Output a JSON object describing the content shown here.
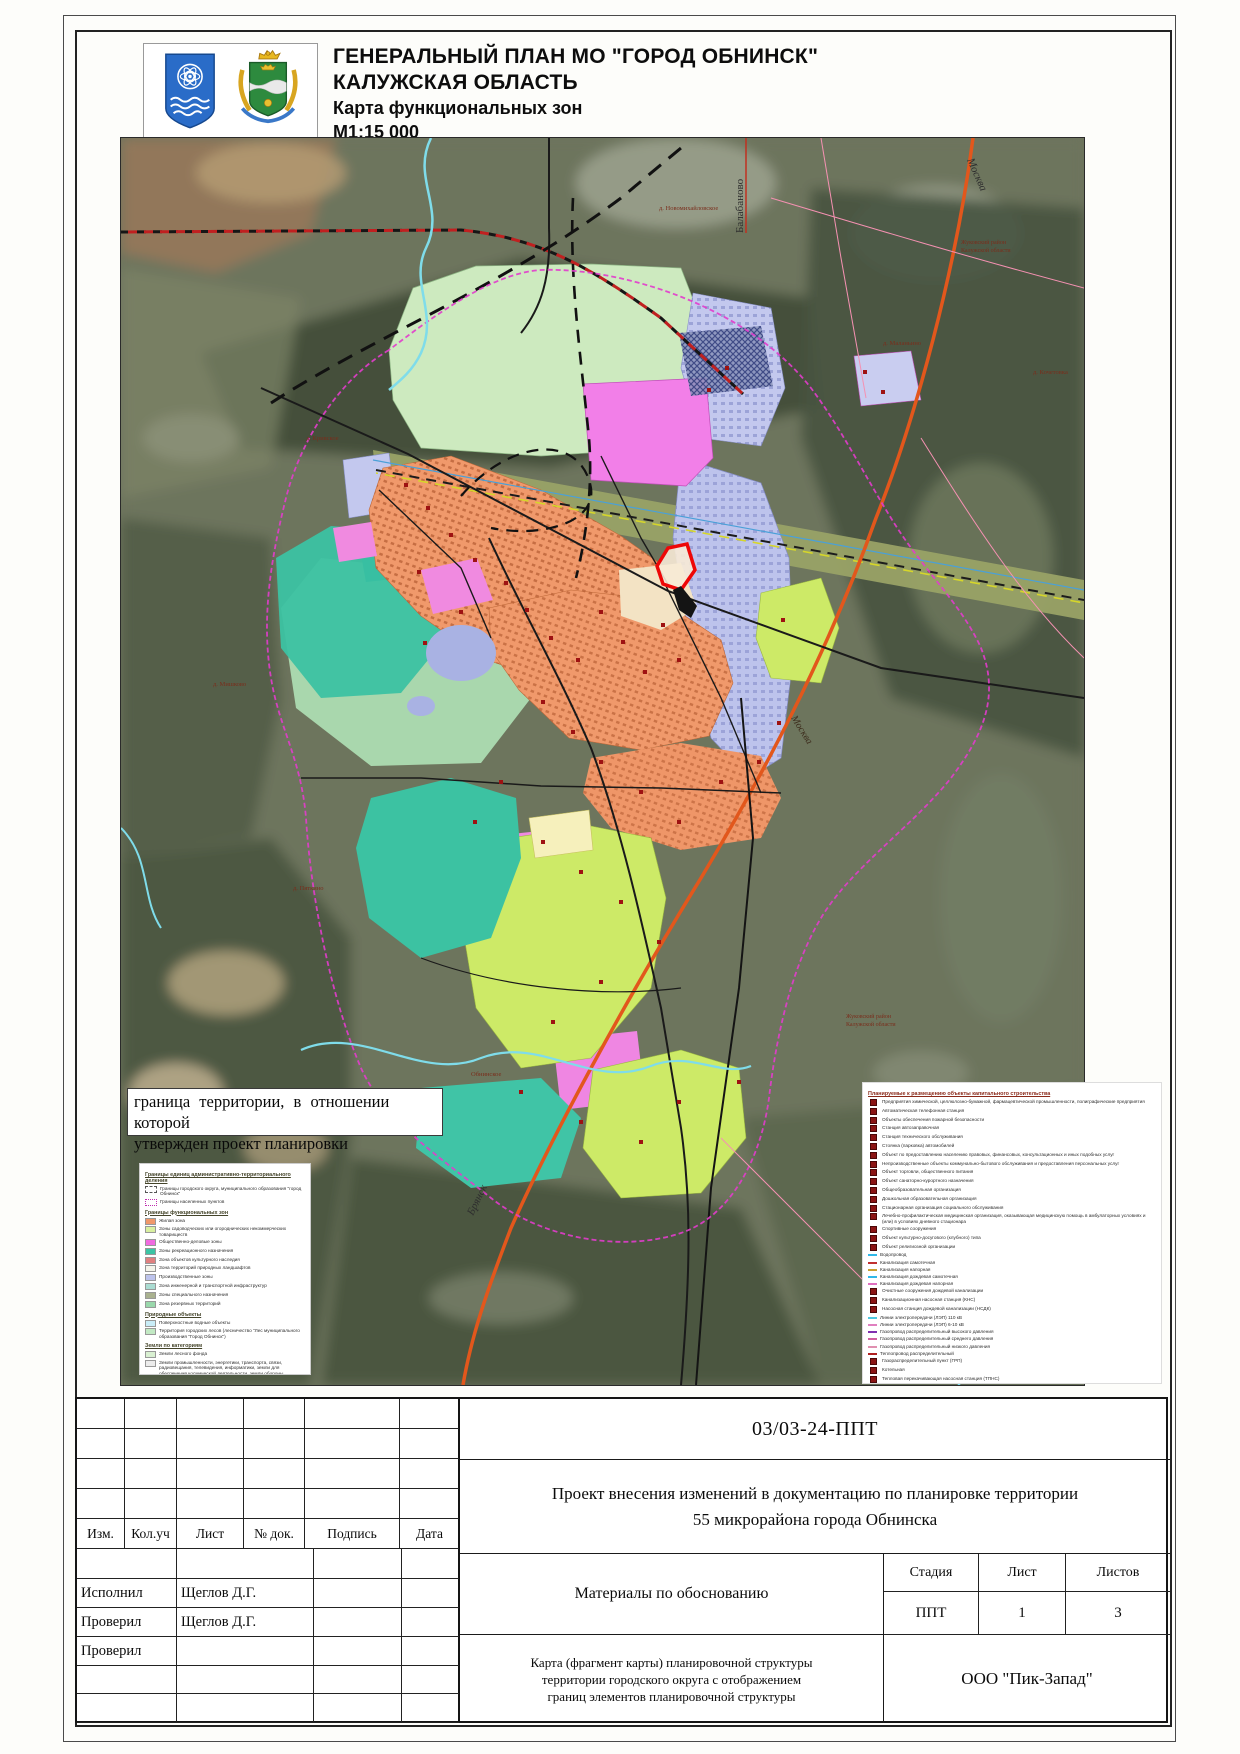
{
  "header": {
    "title_line1": "ГЕНЕРАЛЬНЫЙ ПЛАН МО \"ГОРОД ОБНИНСК\"",
    "title_line2": "КАЛУЖСКАЯ ОБЛАСТЬ",
    "title_line3": "Карта функциональных зон",
    "scale": "М1:15 000",
    "logos": [
      "obninsk-coat-of-arms",
      "kaluga-oblast-coat-of-arms"
    ]
  },
  "map": {
    "note_line1": "граница территории, в отношении которой",
    "note_line2": "утвержден проект планировки",
    "labels": {
      "balabanovo": "Балабаново",
      "moscow_top": "Москва",
      "moscow_right": "Москва",
      "bryansk": "Брянск",
      "novomikhaylovskoe": "д. Новомихайловское",
      "malanino": "д. Маланьино",
      "krivskoe": "д. Кривское",
      "obninskoe": "Обнинское",
      "zhukovsky_1": "Жуковский район",
      "zhukovsky_2": "Калужской области",
      "mishkovo": "д. Мишково",
      "pyatkino": "д. Пяткино",
      "kochetovka": "д. Кочетовка"
    },
    "colors": {
      "residential": "#f0996b",
      "public_business": "#f27fe8",
      "industrial": "#bdc3ec",
      "recreation": "#3cc2a2",
      "gardening": "#cdea67",
      "pale_green_zone": "#cdeabf",
      "city_forest": "#a9d7ad",
      "railway_band": "#99a266",
      "highway_orange": "#e2571c",
      "water": "#7fdcea",
      "project_boundary_red": "#ee0707",
      "city_boundary_magenta": "#e23ccc"
    }
  },
  "legend_left": {
    "sections": [
      {
        "heading": "Границы единиц административно-территориального деления",
        "items": [
          {
            "sym": "admin1",
            "label": "Границы городского округа, муниципального образования \"город Обнинск\""
          },
          {
            "sym": "admin2",
            "label": "Границы населенных пунктов"
          }
        ]
      },
      {
        "heading": "Границы функциональных зон",
        "items": [
          {
            "sym": "swatch",
            "color": "#f0986a",
            "label": "Жилая зона"
          },
          {
            "sym": "swatch",
            "color": "#d9f0a0",
            "label": "Зоны садоводческих или огороднических некоммерческих товариществ"
          },
          {
            "sym": "swatch",
            "color": "#f06ae0",
            "label": "Общественно-деловые зоны"
          },
          {
            "sym": "swatch",
            "color": "#3cc4a4",
            "label": "Зоны рекреационного назначения"
          },
          {
            "sym": "swatch",
            "color": "#e08080",
            "label": "Зона объектов культурного наследия"
          },
          {
            "sym": "swatch",
            "color": "#f4f4ea",
            "label": "Зона территорий природных ландшафтов"
          },
          {
            "sym": "swatch",
            "color": "#bdc3ec",
            "label": "Производственные зоны"
          },
          {
            "sym": "swatch",
            "color": "#aadcd2",
            "label": "Зона инженерной и транспортной инфраструктур"
          },
          {
            "sym": "swatch",
            "color": "#a9b18f",
            "label": "Зоны специального назначения"
          },
          {
            "sym": "swatch",
            "color": "#9ad8ac",
            "label": "Зона резервных территорий"
          }
        ]
      },
      {
        "heading": "Природные объекты",
        "items": [
          {
            "sym": "swatch",
            "color": "#c9edf8",
            "label": "Поверхностные водные объекты"
          },
          {
            "sym": "swatch",
            "color": "#c2e9c4",
            "label": "Территория городских лесов (лесничество \"Лес муниципального образования \"Город Обнинск\")"
          }
        ]
      },
      {
        "heading": "Земли по категориям",
        "items": [
          {
            "sym": "swatch",
            "color": "#d9f0d2",
            "label": "Земли лесного фонда"
          },
          {
            "sym": "swatch",
            "color": "#ececec",
            "label": "Земли промышленности, энергетики, транспорта, связи, радиовещания, телевидения, информатики, земли для обеспечения космической деятельности, земли обороны, безопасности и земли иного специального назначения"
          },
          {
            "sym": "outline",
            "color": "#fdfbe0",
            "label": "Земли сельскохозяйственного использования"
          }
        ]
      },
      {
        "heading": "Объекты транспортной инфраструктуры",
        "note": "сущ.  план.",
        "items": [
          {
            "sym": "pair",
            "color": "#c01818",
            "label": "Автомобильные дороги федерального значения"
          },
          {
            "sym": "pair",
            "color": "#8b1515",
            "label": "Автомобильные дороги регионального значения"
          },
          {
            "sym": "line",
            "color": "#8b1515",
            "label": "Автомобильные дороги местного значения"
          },
          {
            "sym": "pair",
            "color": "#222222",
            "label": "Магистральные улицы общегородского значения"
          },
          {
            "sym": "dline",
            "color": "#222222",
            "label": "Магистральные улицы районного значения"
          },
          {
            "sym": "dline",
            "color": "#555555",
            "label": "Улицы и дороги местного значения"
          },
          {
            "sym": "sq",
            "color": "#111111",
            "label": "Железнодорожный путь общего пользования"
          }
        ]
      }
    ]
  },
  "legend_right": {
    "heading": "Планируемые к размещению объекты капитального строительства",
    "items": [
      {
        "sym": "sq",
        "label": "Предприятия химической, целлюлозно-бумажной, фармацевтической промышленности, полиграфические предприятия"
      },
      {
        "sym": "sq",
        "label": "Автоматическая телефонная станция"
      },
      {
        "sym": "sq",
        "label": "Объекты обеспечения пожарной безопасности"
      },
      {
        "sym": "sq",
        "label": "Станция автозаправочная"
      },
      {
        "sym": "sq",
        "label": "Станция технического обслуживания"
      },
      {
        "sym": "sq",
        "label": "Стоянка (парковка) автомобилей"
      },
      {
        "sym": "sq",
        "label": "Объект по предоставлению населению правовых, финансовых, консультационных и иных подобных услуг"
      },
      {
        "sym": "sq",
        "label": "Непроизводственные объекты коммунально-бытового обслуживания и предоставления персональных услуг"
      },
      {
        "sym": "sq",
        "label": "Объект торговли, общественного питания"
      },
      {
        "sym": "sq",
        "label": "Объект санаторно-курортного назначения"
      },
      {
        "sym": "sq",
        "label": "Общеобразовательная организация"
      },
      {
        "sym": "sq",
        "label": "Дошкольная образовательная организация"
      },
      {
        "sym": "sq",
        "label": "Стационарная организация социального обслуживания"
      },
      {
        "sym": "sq",
        "label": "Лечебно-профилактическая медицинская организация, оказывающая медицинскую помощь в амбулаторных условиях и (или) в условиях дневного стационара"
      },
      {
        "sym": "sq",
        "label": "Спортивные сооружения"
      },
      {
        "sym": "sq",
        "label": "Объект культурно-досугового (клубного) типа"
      },
      {
        "sym": "sq",
        "label": "Объект религиозной организации"
      },
      {
        "sym": "line",
        "color": "#30b8e8",
        "label": "Водопровод"
      },
      {
        "sym": "line",
        "color": "#c03030",
        "label": "Канализация самотечная"
      },
      {
        "sym": "line",
        "color": "#c8a030",
        "label": "Канализация напорная"
      },
      {
        "sym": "dline",
        "color": "#30b8e8",
        "label": "Канализация дождевая самотечная"
      },
      {
        "sym": "line",
        "color": "#e070c0",
        "label": "Канализация дождевая напорная"
      },
      {
        "sym": "sq",
        "label": "Очистные сооружения дождевой канализации"
      },
      {
        "sym": "sq",
        "label": "Канализационная насосная станция (КНС)"
      },
      {
        "sym": "sq",
        "label": "Насосная станция дождевой канализации (НСДК)"
      },
      {
        "sym": "line",
        "color": "#50c8e0",
        "label": "Линии электропередачи (ЛЭП) 110 кВ"
      },
      {
        "sym": "line",
        "color": "#e080c0",
        "label": "Линии электропередачи (ЛЭП) 6-10 кВ"
      },
      {
        "sym": "dline",
        "color": "#8030b0",
        "label": "Газопровод распределительный высокого давления"
      },
      {
        "sym": "dline",
        "color": "#d060a0",
        "label": "Газопровод распределительный среднего давления"
      },
      {
        "sym": "dline",
        "color": "#e090b0",
        "label": "Газопровод распределительный низкого давления"
      },
      {
        "sym": "line",
        "color": "#b02020",
        "label": "Теплопровод распределительный"
      },
      {
        "sym": "sq",
        "label": "Газораспределительный пункт (ГРП)"
      },
      {
        "sym": "sq",
        "label": "Котельная"
      },
      {
        "sym": "sq",
        "label": "Тепловая перекачивающая насосная станция (ТПНС)"
      },
      {
        "sym": "boxsq",
        "label": "Планируемая промышленная (индустриальная) зона"
      }
    ],
    "subheading": "Магистральные трубопроводы федерального значения",
    "sub_note": "сущ.  план.",
    "sub_items": [
      {
        "sym": "pair",
        "color": "#8a8a30",
        "label": "Магистральный газопровод"
      }
    ]
  },
  "title_block": {
    "doc_number": "03/03-24-ППТ",
    "project_line1": "Проект внесения изменений в документацию по планировке территории",
    "project_line2": "55 микрорайона города Обнинска",
    "columns": {
      "izm": "Изм.",
      "kol": "Кол.уч",
      "list": "Лист",
      "doc": "№ док.",
      "sign": "Подпись",
      "date": "Дата"
    },
    "rows": [
      {
        "role": "Исполнил",
        "name": "Щеглов Д.Г."
      },
      {
        "role": "Проверил",
        "name": "Щеглов Д.Г."
      },
      {
        "role": "Проверил",
        "name": ""
      }
    ],
    "materials": "Материалы по обоснованию",
    "stage_header": {
      "stage": "Стадия",
      "sheet": "Лист",
      "sheets": "Листов"
    },
    "stage_values": {
      "stage": "ППТ",
      "sheet": "1",
      "sheets": "3"
    },
    "map_title_line1": "Карта (фрагмент карты) планировочной структуры",
    "map_title_line2": "территории городского округа с отображением",
    "map_title_line3": "границ элементов планировочной структуры",
    "organization": "ООО \"Пик-Запад\""
  }
}
